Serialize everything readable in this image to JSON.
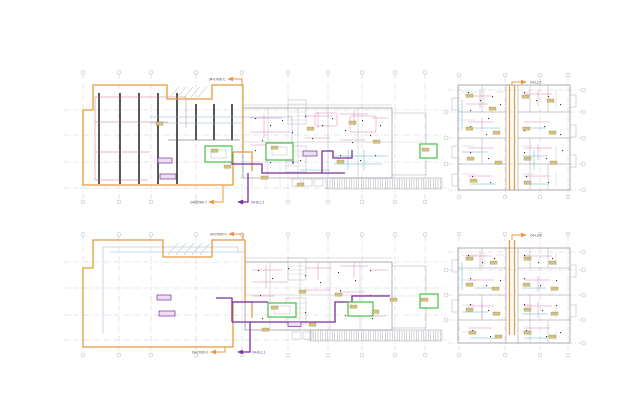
{
  "canvas": {
    "width": 640,
    "height": 420,
    "background": "#ffffff"
  },
  "palette": {
    "outline_orange": "#E8993F",
    "route_purple": "#7B2D9B",
    "room_green": "#44C044",
    "wiring_pink": "#D678AE",
    "wiring_cyan": "#4AB0C0",
    "wiring_blue": "#85B4DD",
    "wiring_red": "#C4637A",
    "tag_fill": "#D5C17F",
    "grid_gray": "#C4C4CA",
    "wall_gray": "#9A9AA2",
    "ink": "#303030"
  },
  "plans": [
    {
      "id": "basement-level-1",
      "position": "top-left",
      "type": "parking-floor-plan",
      "refs": {
        "top": "04-07000 C",
        "bottom_left": "04-07000 J",
        "bottom_right": "04-KL1.1"
      }
    },
    {
      "id": "tower-level-1",
      "position": "top-right",
      "type": "apartment-floor-plan",
      "refs": {
        "top": "04-L2.5"
      }
    },
    {
      "id": "basement-level-2",
      "position": "bottom-left",
      "type": "parking-floor-plan",
      "refs": {
        "top": "04-07000 V",
        "bottom_left": "04-07000 J",
        "bottom_right": "04-KL1.1"
      },
      "notes": [
        "· ·· ····· ··",
        "···· ·· ··"
      ]
    },
    {
      "id": "tower-level-2",
      "position": "bottom-right",
      "type": "apartment-floor-plan",
      "refs": {
        "top": "04-L2.5"
      },
      "notes": [
        "·· ····· ···",
        "··· ····"
      ]
    }
  ]
}
